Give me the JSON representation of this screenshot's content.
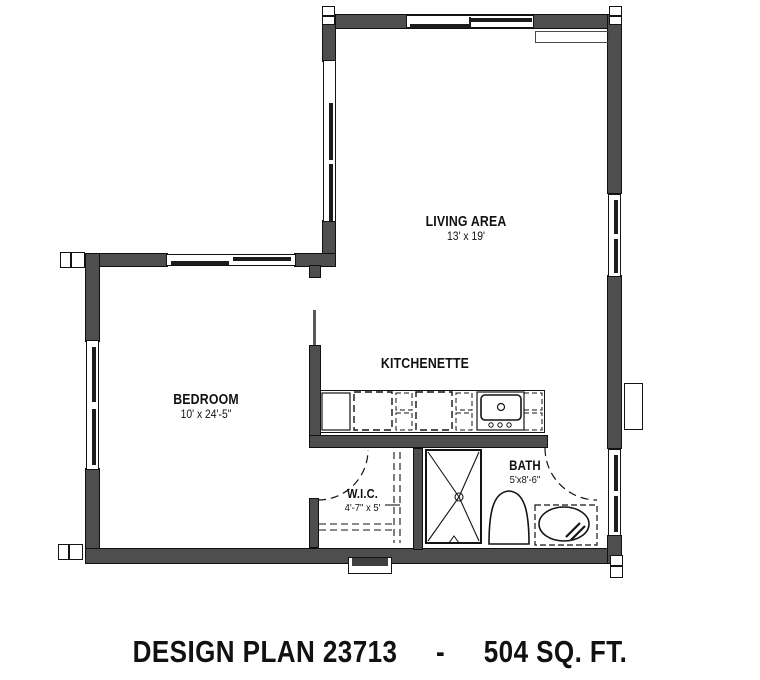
{
  "drawing": {
    "type": "floor-plan",
    "background": "#ffffff",
    "wall_color": "#4e4e4e",
    "line_color": "#141414"
  },
  "rooms": {
    "living": {
      "label": "LIVING AREA",
      "dims": "13' x 19'"
    },
    "bedroom": {
      "label": "BEDROOM",
      "dims": "10' x 24'-5\""
    },
    "kitchenette": {
      "label": "KITCHENETTE"
    },
    "wic": {
      "label": "W.I.C.",
      "dims": "4'-7\" x 5'"
    },
    "bath": {
      "label": "BATH",
      "dims": "5'x8'-6\""
    }
  },
  "fixtures": {
    "shower": "shower-stall",
    "toilet": "toilet",
    "vanity": "vanity-sink",
    "range": "range-oven",
    "refrigerator": "refrigerator",
    "counter": "kitchen-counter",
    "closet_shelving": "closet-shelf-rod",
    "doors": [
      "wic-door-swing",
      "bath-door-swing"
    ]
  },
  "footer": {
    "plan_label": "DESIGN PLAN 23713",
    "separator": "-",
    "area_label": "504 SQ. FT."
  }
}
